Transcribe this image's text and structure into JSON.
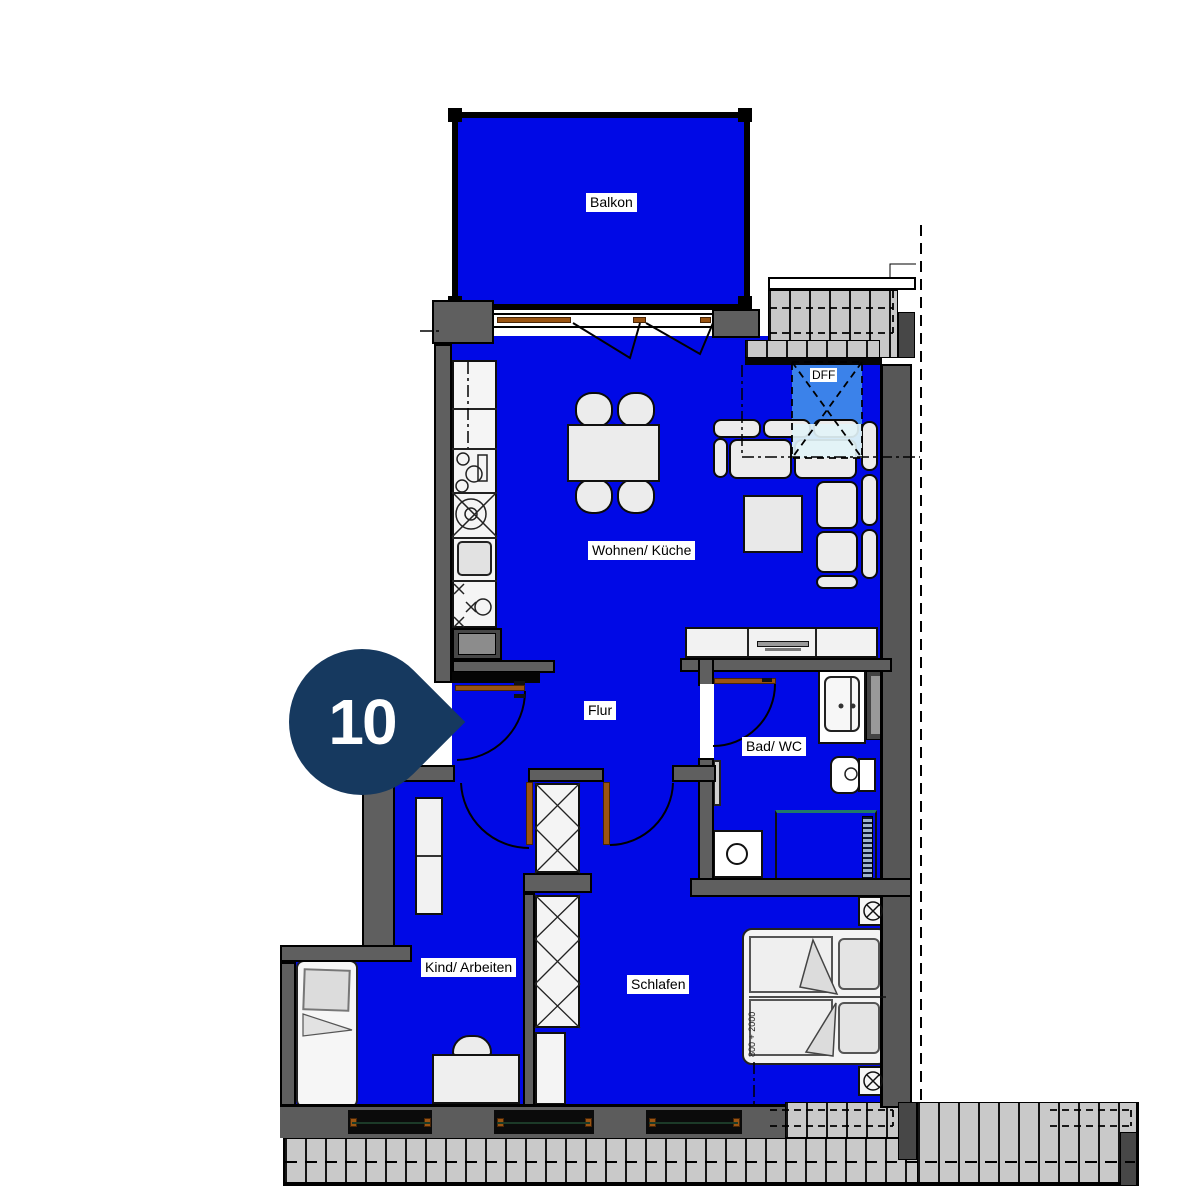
{
  "floorplan": {
    "marker": {
      "number": "10"
    },
    "rooms": {
      "balkon": {
        "label": "Balkon"
      },
      "wohnen_kueche": {
        "label": "Wohnen/ Küche"
      },
      "flur": {
        "label": "Flur"
      },
      "bad_wc": {
        "label": "Bad/ WC"
      },
      "kind_arbeiten": {
        "label": "Kind/ Arbeiten"
      },
      "schlafen": {
        "label": "Schlafen"
      },
      "roof_window": {
        "label": "DFF"
      }
    },
    "annotations": {
      "bed_dimension": "800 + 2000"
    },
    "colors": {
      "room_fill": "#0009e6",
      "roof_window_fill": "#3b82ea",
      "marker_fill": "#16395f",
      "wall_gray": "#5f5f5f"
    }
  }
}
